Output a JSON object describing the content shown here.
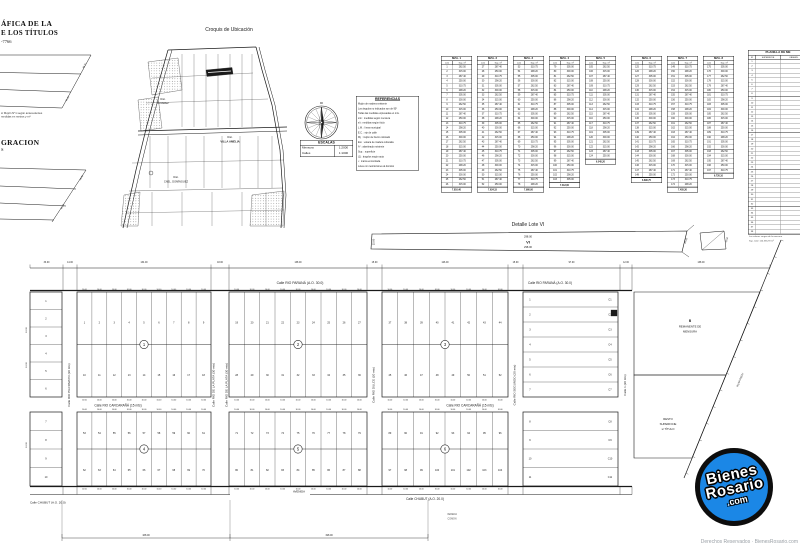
{
  "page": {
    "bg": "#ffffff",
    "ink": "#1a1a1a",
    "faint": "#555555"
  },
  "header_left": {
    "line1": "ÁFICA DE LA",
    "line2": "E LOS TÍTULOS",
    "ref": "-7766",
    "note1": "s/ Mojón N°1 según antecedentes",
    "note2": "medidas en metros y m²",
    "section2": "GRACION",
    "section2_sub": "S"
  },
  "croquis": {
    "title": "Croquis de Ubicación",
    "labels": {
      "d1a": "Dist.",
      "d1b": "ÁLVAREZ",
      "d2a": "Dist.",
      "d2b": "VILLA AMELIA",
      "d3a": "Dist.",
      "d3b": "CNEL. DOMÍNGUEZ"
    }
  },
  "escalas": {
    "title": "ESCALAS",
    "rows": [
      [
        "Mensura",
        "1:2000"
      ],
      [
        "Calles",
        "1:1000"
      ]
    ]
  },
  "referencias": {
    "title": "REFERENCIAS",
    "lines": [
      "Mojón de madera existente",
      "Los ángulos no indicados son de 90°",
      "Todas las medidas expresadas en mts.",
      "s/m : medidas según mensura",
      "s/t : medidas según título",
      "L.M. : línea municipal",
      "E.C. : eje de calle",
      "Mj. : mojón de hierro colocado",
      "Est. : estaca de madera colocada",
      "A° : alambrado existente",
      "Sup. : superficie",
      "(1) : ángulos según acta",
      "• : marca encontrada",
      "Lotes con restricciones al dominio"
    ]
  },
  "mini_tables": {
    "col1": "Lote",
    "col2": "Sup. m²",
    "area_cycle": [
      "300.00",
      "262.50",
      "315.00",
      "287.40",
      "250.00",
      "310.75",
      "298.20",
      "305.00"
    ],
    "tables": [
      {
        "title": "MZA. 1",
        "rows": 26,
        "start": 1,
        "total": "7.810,40"
      },
      {
        "title": "MZA. 2",
        "rows": 26,
        "start": 27,
        "total": "7.624,15"
      },
      {
        "title": "MZA. 3",
        "rows": 26,
        "start": 53,
        "total": "7.980,00"
      },
      {
        "title": "MZA. 4",
        "rows": 25,
        "start": 79,
        "total": "7.312,60"
      },
      {
        "title": "MZA. 5",
        "rows": 20,
        "start": 105,
        "total": "6.045,20"
      },
      {
        "title": "MZA. 6",
        "rows": 24,
        "start": 125,
        "total": "6.890,75"
      },
      {
        "title": "MZA. 7",
        "rows": 26,
        "start": 149,
        "total": "7.455,30"
      },
      {
        "title": "MZA. 8",
        "rows": 23,
        "start": 175,
        "total": "6.720,10"
      }
    ]
  },
  "planilla": {
    "title": "PLANILLA DE ME",
    "col1": "N°",
    "col2": "SUPERFICIE",
    "col3": "OBSERV.",
    "rows": 38,
    "foot1": "Los valores surgen de la mensura",
    "foot2": "Sup. total: 124.356,78 m²"
  },
  "detalle": {
    "title": "Detalle Lote VI",
    "lot": "VI",
    "dim_top": "298.00",
    "dim_bottom": "298.00",
    "dim_left": "15.00",
    "dim_right": "15.02",
    "dim_fig": "12.50"
  },
  "plan": {
    "streets": {
      "parana": "Calle RIO PARANÁ (A.O. 30.0)",
      "carcarana": "Calle RIO CARCARAÑÁ (15 mts)",
      "chubut": "Calle CHUBUT (A.O. 20.0)",
      "avenida": "AVENIDA"
    },
    "v_streets": [
      {
        "x1": 63,
        "x2": 77,
        "label": "Calle RIO PILCOMAYO (30 mts)",
        "two": false
      },
      {
        "x1": 211,
        "x2": 229,
        "label": "Calle RIO DE LA PLATA (30 mts)",
        "two": true
      },
      {
        "x1": 367,
        "x2": 382,
        "label": "Calle RIO DULCE (20 mts)",
        "two": false
      },
      {
        "x1": 508,
        "x2": 523,
        "label": "Calle RIO SEGUNDO (20 mts)",
        "two": false
      },
      {
        "x1": 620,
        "x2": 632,
        "label": "Calle 1 (20 mts)",
        "two": false
      }
    ],
    "blocks": [
      {
        "type": "stack",
        "x": 30,
        "y": 292,
        "w": 32,
        "h": 105,
        "rows": 6,
        "start": 1
      },
      {
        "type": "stack",
        "x": 30,
        "y": 412,
        "w": 32,
        "h": 74,
        "rows": 4,
        "start": 7
      },
      {
        "type": "grid",
        "x": 77,
        "y": 292,
        "w": 134,
        "h": 105,
        "cols": 9,
        "start": 1,
        "circle": "1"
      },
      {
        "type": "grid",
        "x": 229,
        "y": 292,
        "w": 138,
        "h": 105,
        "cols": 9,
        "start": 19,
        "circle": "2"
      },
      {
        "type": "grid",
        "x": 382,
        "y": 292,
        "w": 126,
        "h": 105,
        "cols": 8,
        "start": 37,
        "circle": "3"
      },
      {
        "type": "strips",
        "x": 523,
        "y": 292,
        "w": 95,
        "h": 105,
        "rows": 7,
        "start": 1,
        "code0": 0
      },
      {
        "type": "grid",
        "x": 77,
        "y": 412,
        "w": 134,
        "h": 74,
        "cols": 9,
        "start": 53,
        "circle": "4"
      },
      {
        "type": "grid",
        "x": 229,
        "y": 412,
        "w": 138,
        "h": 74,
        "cols": 9,
        "start": 71,
        "circle": "5"
      },
      {
        "type": "grid",
        "x": 382,
        "y": 412,
        "w": 126,
        "h": 74,
        "cols": 8,
        "start": 89,
        "circle": "6"
      },
      {
        "type": "strips",
        "x": 523,
        "y": 412,
        "w": 95,
        "h": 74,
        "rows": 4,
        "start": 8,
        "code0": 7
      }
    ],
    "strip_codes": [
      "C1",
      "C2",
      "C3",
      "C4",
      "C5",
      "C6",
      "C7",
      "C8",
      "C9",
      "C10",
      "C11"
    ],
    "lot_dim": "10.00",
    "parcel_upper": [
      "B",
      "REMANENTE DE",
      "MENSURA"
    ],
    "parcel_lower": [
      "RESTO",
      "SUPERFICIE",
      "s/ TÍTULO"
    ],
    "ruta_label": "RUTA PROV.",
    "bottom_left_label": "Calle CHUBUT (A.O. 20.0)",
    "notes": [
      "VEREDA",
      "COMÚN"
    ],
    "ruler_dims": [
      "168.00",
      "198.00"
    ]
  },
  "trap_dims": {
    "t1a": "45.72",
    "t1b": "51.30",
    "t2a": "38.40",
    "t2b": "42.15"
  },
  "logo": {
    "l1": "Bienes",
    "l2": "Rosario",
    "l3": ".com",
    "blue": "#1b87e6"
  },
  "watermark": "Derechos Reservados · BienesRosario.com"
}
